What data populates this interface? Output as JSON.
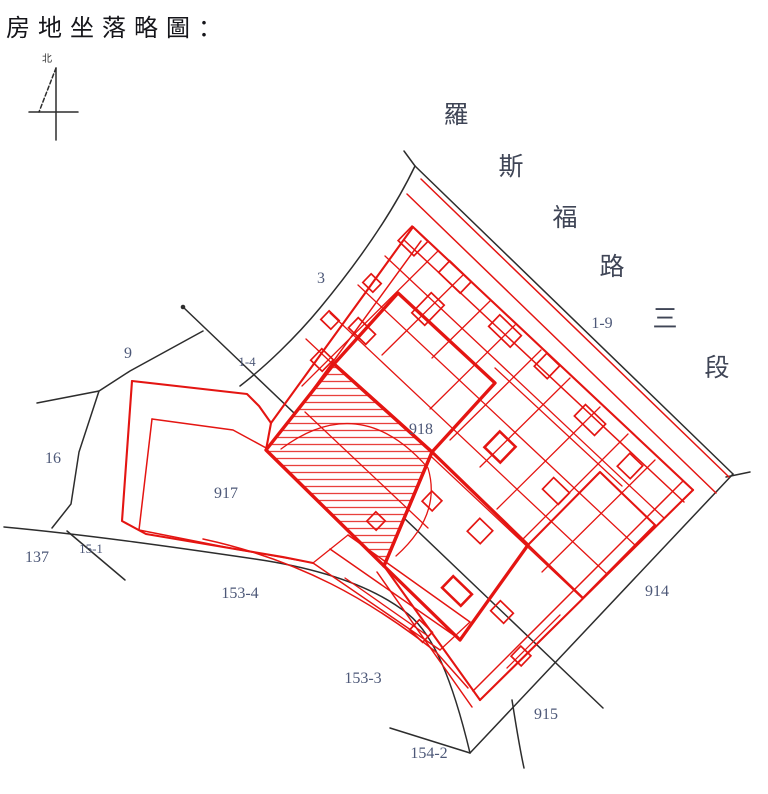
{
  "title": "房地坐落略圖：",
  "compass": {
    "north_label": "北"
  },
  "street": {
    "name": "羅斯福路三段",
    "chars": [
      "羅",
      "斯",
      "福",
      "路",
      "三",
      "段"
    ]
  },
  "labels": {
    "lot_3": "3",
    "lot_1_4": "1-4",
    "lot_9": "9",
    "lot_16": "16",
    "lot_137": "137",
    "lot_15_1": "15-1",
    "lot_153_4": "153-4",
    "lot_153_3": "153-3",
    "lot_154_2": "154-2",
    "lot_915": "915",
    "lot_914": "914",
    "lot_917": "917",
    "lot_918": "918",
    "lot_1_9": "1-9"
  },
  "colors": {
    "parcel_red": "#e41512",
    "boundary_black": "#2d2d2d",
    "label_gray": "#4d5878"
  }
}
